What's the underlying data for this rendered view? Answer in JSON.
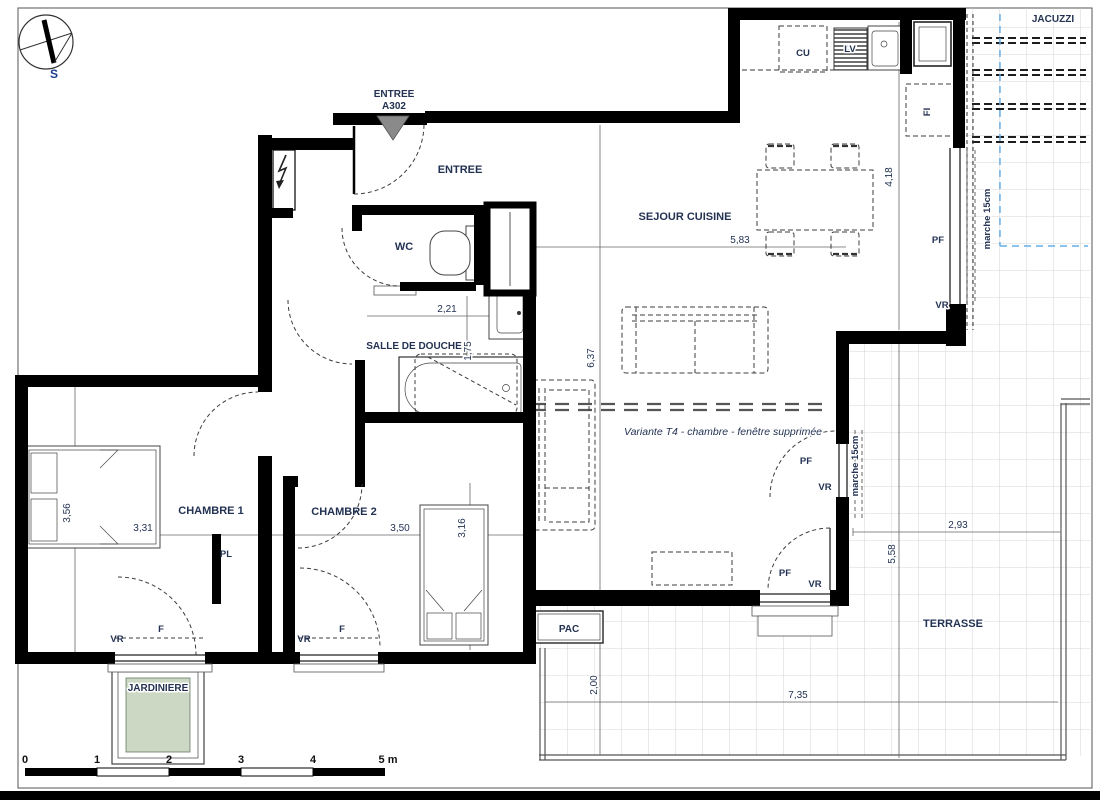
{
  "compass": {
    "south": "S"
  },
  "entry": {
    "title_line1": "ENTREE",
    "title_line2": "A302",
    "room": "ENTREE"
  },
  "rooms": {
    "wc": "WC",
    "shower_room": "SALLE DE DOUCHE",
    "living_kitchen": "SEJOUR CUISINE",
    "bedroom1": "CHAMBRE 1",
    "bedroom2": "CHAMBRE 2",
    "closet": "PL",
    "heat_pump": "PAC",
    "terrace": "TERRASSE",
    "jacuzzi": "JACUZZI",
    "planter": "JARDINIERE"
  },
  "appliances": {
    "stove": "CU",
    "dishwasher": "LV",
    "fridge": "FI"
  },
  "openings": {
    "window": "F",
    "roller_shutter": "VR",
    "french_door": "PF"
  },
  "annotations": {
    "step": "marche 15cm",
    "variant_note": "Variante T4 - chambre - fenêtre supprimée"
  },
  "dimensions": {
    "sejour_width": "5,83",
    "sejour_bay_depth": "4,18",
    "sejour_depth": "6,37",
    "wc_width": "2,21",
    "douche_depth": "1,75",
    "ch1_width": "3,31",
    "ch1_depth": "3,56",
    "ch2_width": "3,50",
    "ch2_depth": "3,16",
    "terrace_east_width": "2,93",
    "terrace_east_depth": "5,58",
    "terrace_south_width": "7,35",
    "terrace_south_depth": "2,00"
  },
  "scale_bar": {
    "ticks": [
      "0",
      "1",
      "2",
      "3",
      "4",
      "5 m"
    ]
  },
  "colors": {
    "wall": "#000000",
    "text": "#233253",
    "planter": "#ccd8c4",
    "grid_line": "#cacaca",
    "blue_guide": "#64b0e8",
    "entry_arrow": "#8a8a8a"
  }
}
